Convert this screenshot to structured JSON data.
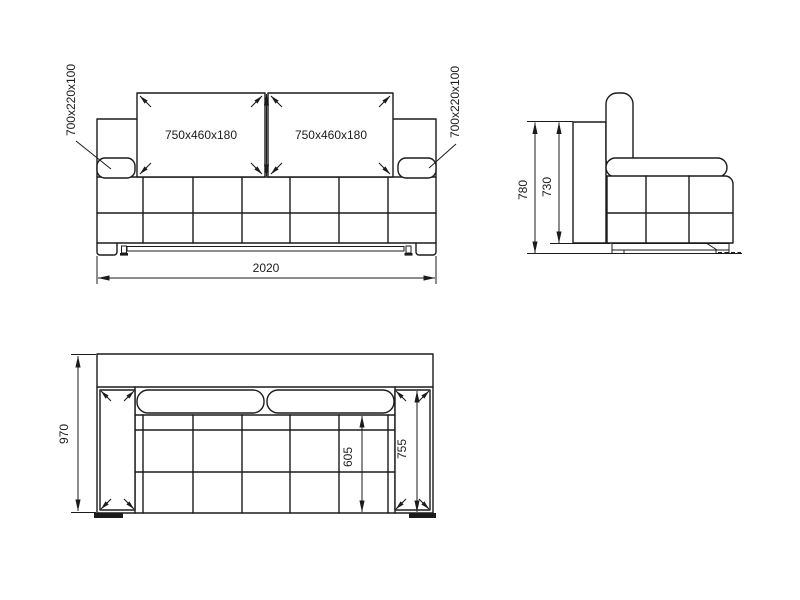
{
  "colors": {
    "background": "#ffffff",
    "line": "#1b1b1b",
    "text": "#1b1b1b"
  },
  "front_view": {
    "back_cushion_left": "750x460x180",
    "back_cushion_right": "750x460x180",
    "armrest_cushion_left": "700x220x100",
    "armrest_cushion_right": "700x220x100",
    "overall_width": "2020"
  },
  "side_view": {
    "overall_height": "780",
    "frame_height": "730"
  },
  "top_view": {
    "overall_depth": "970",
    "seat_depth": "605",
    "armrest_length": "755"
  }
}
